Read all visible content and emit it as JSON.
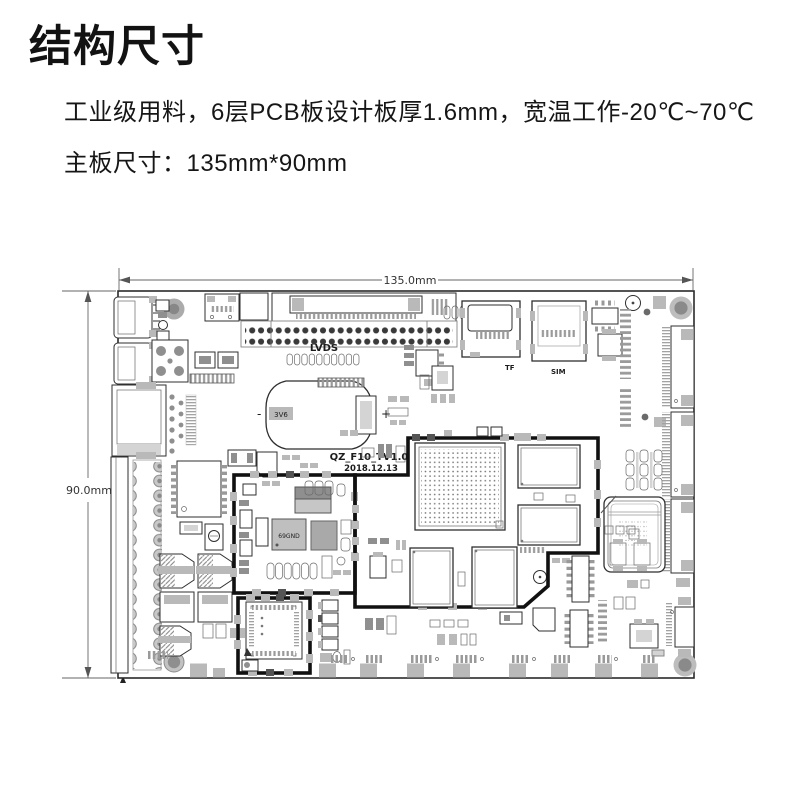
{
  "page": {
    "title": "结构尺寸",
    "specs": [
      "工业级用料，6层PCB板设计板厚1.6mm，宽温工作-20℃~70℃",
      "主板尺寸：135mm*90mm"
    ]
  },
  "diagram": {
    "width_label": "135.0mm",
    "height_label": "90.0mm",
    "silkscreen": {
      "lvds": "LVDS",
      "tf": "TF",
      "sim": "SIM",
      "model": "QZ_F10_TV1.0",
      "date": "2018.12.13",
      "plus": "+",
      "minus": "-",
      "battery_mark": "3V6",
      "pmic_mark": "69GND"
    },
    "colors": {
      "line": "#2f2f2f",
      "module_outline": "#111111",
      "pad": "#b9b9b9",
      "pad_dark": "#8f8f8f",
      "background": "#ffffff"
    }
  }
}
